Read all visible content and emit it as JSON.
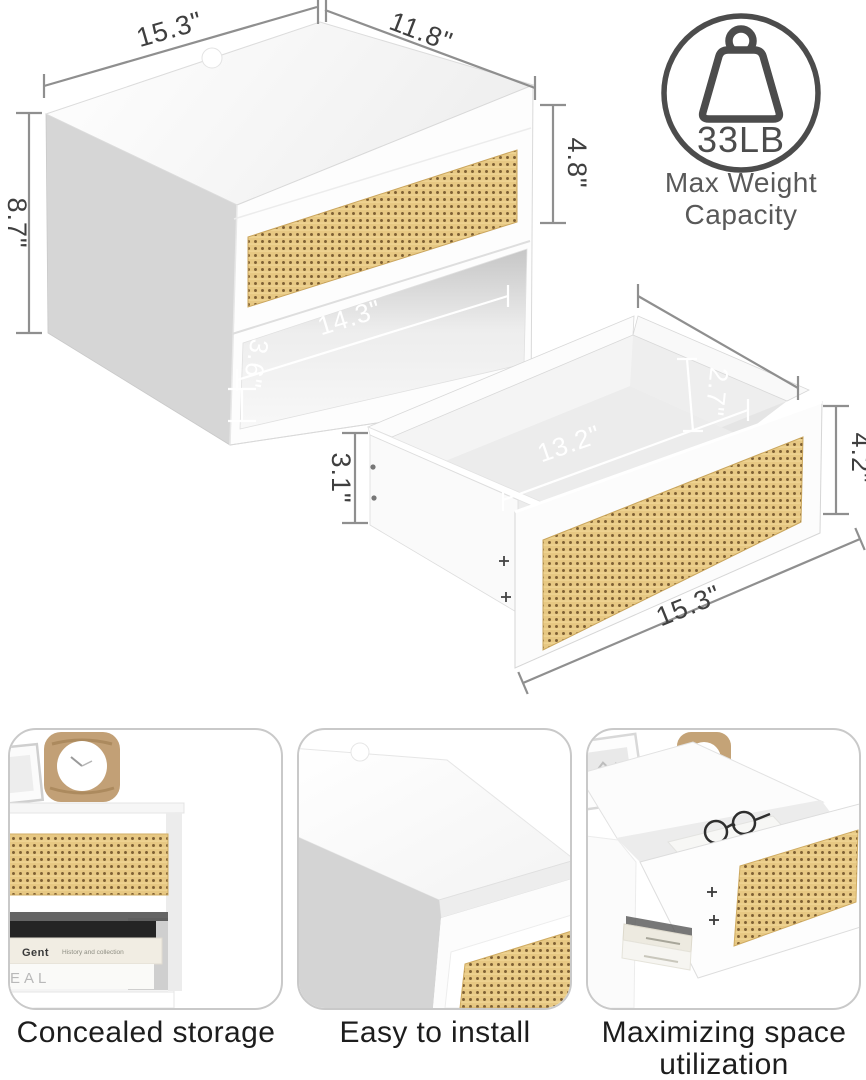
{
  "assembled_unit": {
    "name": "Wall-mounted rattan nightstand, assembled view",
    "dimensions": {
      "top_width": "15.3\"",
      "top_depth": "11.8\"",
      "side_height": "8.7\"",
      "drawer_front_height": "4.8\"",
      "shelf_inner_width": "14.3\"",
      "shelf_inner_height": "3.6\""
    }
  },
  "weight_badge": {
    "icon": "kettlebell-weight-icon",
    "value": "33LB",
    "caption_line1": "Max Weight",
    "caption_line2": "Capacity"
  },
  "drawer_unit": {
    "name": "Drawer detail view",
    "dimensions": {
      "inner_depth": "2.7\"",
      "inner_width": "13.2\"",
      "side_height": "3.1\"",
      "front_height": "4.2\"",
      "outer_width": "15.3\""
    }
  },
  "features": [
    {
      "caption": "Concealed storage",
      "image": "nightstand-front-with-clock-and-books-photo",
      "book_title": "Gent",
      "book_subtitle": "History and collection",
      "magazine_text": "EAL"
    },
    {
      "caption": "Easy to install",
      "image": "white-tabletop-corner-closeup-photo"
    },
    {
      "caption": "Maximizing space utilization",
      "image": "nightstand-open-drawer-with-glasses-photo"
    }
  ],
  "colors": {
    "rattan": "#e7c883",
    "rattan_hole": "#7d5f33",
    "dimension_line": "#8f8f8f",
    "dimension_text": "#3f3f3f",
    "inner_dimension_text": "#ffffff",
    "badge_gray": "#4c4c4c",
    "caption_text": "#1d1d1d",
    "side_panel_gray": "#d6d6d6",
    "card_border": "#c9c9c9"
  }
}
